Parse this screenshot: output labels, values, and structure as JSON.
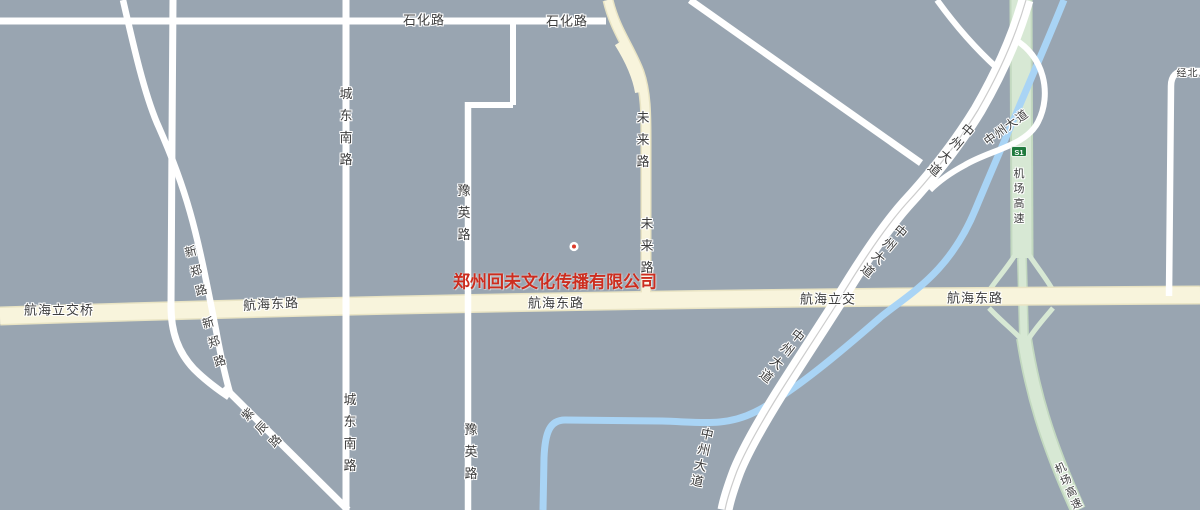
{
  "map": {
    "colors": {
      "background": "#99a5b1",
      "road_white": "#ffffff",
      "road_yellow": "#f8f4dc",
      "road_yellow_casing": "#e9e4c4",
      "road_green": "#d7e8d4",
      "road_green_casing": "#c3d9c0",
      "river_blue": "#a9d4f5",
      "centerline_gray": "#cccccc",
      "label_gray": "#3e3e3e",
      "poi_red": "#cc2d1f",
      "badge_green": "#1f7a3d"
    },
    "s1_badge": {
      "text": "S1"
    },
    "poi": {
      "name": "郑州回未文化传播有限公司"
    },
    "labels": [
      {
        "id": "shihua-lu-1",
        "text": "石化路",
        "type": "h",
        "x": 424,
        "y": 19,
        "size": 13
      },
      {
        "id": "shihua-lu-2",
        "text": "石化路",
        "type": "h",
        "x": 567,
        "y": 20,
        "size": 13
      },
      {
        "id": "chengdongnan-lu-1",
        "text": "城东南路",
        "type": "v",
        "x": 346,
        "y": 127,
        "size": 13,
        "spacing": 22
      },
      {
        "id": "chengdongnan-lu-2",
        "text": "城东南路",
        "type": "v",
        "x": 350,
        "y": 433,
        "size": 13,
        "spacing": 22
      },
      {
        "id": "yuying-lu-1",
        "text": "豫英路",
        "type": "v",
        "x": 464,
        "y": 213,
        "size": 13,
        "spacing": 22
      },
      {
        "id": "yuying-lu-2",
        "text": "豫英路",
        "type": "v",
        "x": 471,
        "y": 452,
        "size": 13,
        "spacing": 22
      },
      {
        "id": "weilai-lu-1",
        "text": "未来路",
        "type": "v",
        "x": 643,
        "y": 140,
        "size": 13,
        "spacing": 22
      },
      {
        "id": "weilai-lu-2",
        "text": "未来路",
        "type": "v",
        "x": 647,
        "y": 246,
        "size": 13,
        "spacing": 22
      },
      {
        "id": "xinzheng-lu-1",
        "text": "新郑路",
        "type": "v",
        "x": 196,
        "y": 271,
        "size": 12,
        "spacing": 20,
        "angle": -15
      },
      {
        "id": "xinzheng-lu-2",
        "text": "新郑路",
        "type": "v",
        "x": 214,
        "y": 342,
        "size": 12,
        "spacing": 20,
        "angle": -17
      },
      {
        "id": "zichen-lu",
        "text": "紫辰路",
        "type": "v",
        "x": 262,
        "y": 428,
        "size": 12,
        "spacing": 19,
        "angle": -46
      },
      {
        "id": "hanghai-lijiaoqiao",
        "text": "航海立交桥",
        "type": "h",
        "x": 59,
        "y": 309,
        "size": 13
      },
      {
        "id": "hanghai-donglu-1",
        "text": "航海东路",
        "type": "h",
        "x": 271,
        "y": 303,
        "size": 13,
        "angle": -3
      },
      {
        "id": "hanghai-donglu-2",
        "text": "航海东路",
        "type": "h",
        "x": 556,
        "y": 302,
        "size": 13
      },
      {
        "id": "hanghai-lijiao",
        "text": "航海立交",
        "type": "h",
        "x": 828,
        "y": 298,
        "size": 13
      },
      {
        "id": "hanghai-donglu-3",
        "text": "航海东路",
        "type": "h",
        "x": 975,
        "y": 297,
        "size": 13
      },
      {
        "id": "zhongzhou-dadao-1",
        "text": "中州大道",
        "type": "v",
        "x": 951,
        "y": 150,
        "size": 13,
        "spacing": 17,
        "angle": 40
      },
      {
        "id": "zhongzhou-dadao-2",
        "text": "中州大道",
        "type": "v",
        "x": 884,
        "y": 251,
        "size": 13,
        "spacing": 17,
        "angle": 40
      },
      {
        "id": "zhongzhou-dadao-3",
        "text": "中州大道",
        "type": "h",
        "x": 1006,
        "y": 127,
        "size": 12,
        "angle": -36
      },
      {
        "id": "zhongzhou-dadao-4",
        "text": "中州大道",
        "type": "v",
        "x": 782,
        "y": 356,
        "size": 13,
        "spacing": 17,
        "angle": 38
      },
      {
        "id": "zhongzhou-dadao-5",
        "text": "中州大道",
        "type": "v",
        "x": 702,
        "y": 458,
        "size": 13,
        "spacing": 16,
        "angle": 12
      },
      {
        "id": "jichang-gaosu-1",
        "text": "机场高速",
        "type": "v",
        "x": 1019,
        "y": 197,
        "size": 11,
        "spacing": 15
      },
      {
        "id": "jichang-gaosu-2",
        "text": "机场高速",
        "type": "v",
        "x": 1069,
        "y": 487,
        "size": 11,
        "spacing": 13,
        "angle": -24
      },
      {
        "id": "jingbei-road",
        "text": "经北二",
        "type": "h",
        "x": 1193,
        "y": 72,
        "size": 10
      },
      {
        "id": "company-name",
        "text": "郑州回未文化传播有限公司",
        "type": "h",
        "x": 555,
        "y": 280,
        "size": 17,
        "style": "poi"
      }
    ]
  }
}
